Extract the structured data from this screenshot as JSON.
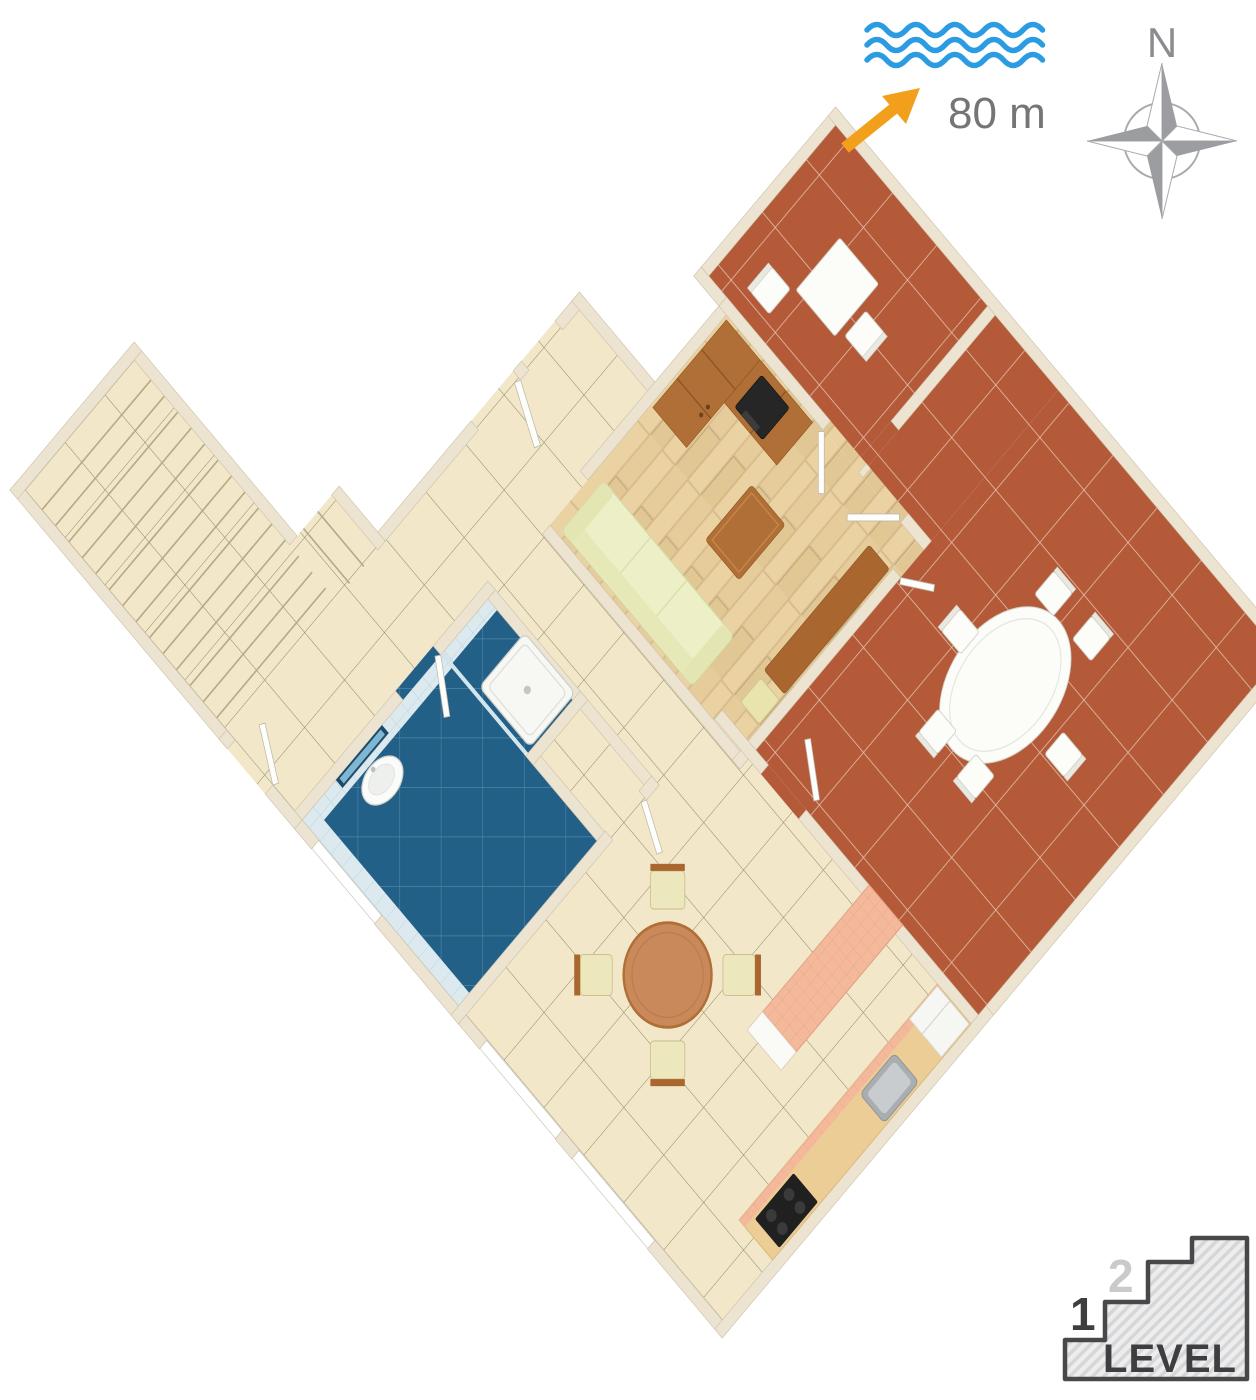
{
  "annotations": {
    "sea": {
      "distance_label": "80 m",
      "wave_color": "#2b9ce2",
      "arrow_color": "#f2a01c",
      "label_color": "#737577"
    },
    "compass": {
      "north_label": "N",
      "star_dark_color": "#9b9da0",
      "star_light_color": "#ffffff",
      "outline_color": "#a8aaad"
    },
    "level": {
      "step1": "1",
      "step2": "2",
      "label": "LEVEL",
      "active_color": "#3e3e40",
      "inactive_color": "#c9cacc",
      "badge_outline_color": "#48484a"
    }
  },
  "floor_plan": {
    "view": "3d-isometric-apartment-plan",
    "colors": {
      "wall": "#ece3d1",
      "beige_tile_floor": "#f2e8c9",
      "terracotta_tile_floor": "#b45a39",
      "blue_bathroom_floor": "#236087",
      "wood_parquet_floor": "#ead2a2",
      "furniture_wood": "#b06f36",
      "sofa": "#edefc6",
      "counter_tile": "#f4b99b"
    },
    "rooms": [
      {
        "name": "staircase",
        "floor": "beige-tile-steps"
      },
      {
        "name": "entrance-hall",
        "floor": "beige-tile"
      },
      {
        "name": "corridor",
        "floor": "beige-tile"
      },
      {
        "name": "living-room",
        "floor": "wood-parquet"
      },
      {
        "name": "bathroom",
        "floor": "blue-tile"
      },
      {
        "name": "shower-cabin",
        "floor": "blue-tile"
      },
      {
        "name": "storage-closet",
        "floor": "beige-tile"
      },
      {
        "name": "kitchen-dining-room",
        "floor": "beige-tile"
      },
      {
        "name": "small-terrace",
        "floor": "terracotta-tile"
      },
      {
        "name": "large-terrace",
        "floor": "terracotta-tile"
      }
    ],
    "furniture": [
      {
        "name": "sofa",
        "room": "living-room"
      },
      {
        "name": "coffee-table",
        "room": "living-room"
      },
      {
        "name": "wardrobe",
        "room": "living-room"
      },
      {
        "name": "tv-cabinet",
        "room": "living-room"
      },
      {
        "name": "tv",
        "room": "living-room"
      },
      {
        "name": "sideboard",
        "room": "living-room"
      },
      {
        "name": "stool",
        "room": "living-room"
      },
      {
        "name": "washbasin",
        "room": "bathroom"
      },
      {
        "name": "mirror",
        "room": "bathroom"
      },
      {
        "name": "shower-tray",
        "room": "shower-cabin"
      },
      {
        "name": "round-dining-table",
        "room": "kitchen-dining-room"
      },
      {
        "name": "dining-chairs",
        "count": 4,
        "room": "kitchen-dining-room"
      },
      {
        "name": "bar-counter",
        "room": "kitchen-dining-room"
      },
      {
        "name": "kitchen-counter",
        "room": "kitchen-dining-room"
      },
      {
        "name": "sink",
        "room": "kitchen-dining-room"
      },
      {
        "name": "stove",
        "room": "kitchen-dining-room"
      },
      {
        "name": "fridge",
        "room": "kitchen-dining-room"
      },
      {
        "name": "square-table",
        "room": "small-terrace"
      },
      {
        "name": "terrace-chairs",
        "count": 2,
        "room": "small-terrace"
      },
      {
        "name": "oval-table",
        "room": "large-terrace"
      },
      {
        "name": "terrace-chairs",
        "count": 6,
        "room": "large-terrace"
      }
    ]
  }
}
